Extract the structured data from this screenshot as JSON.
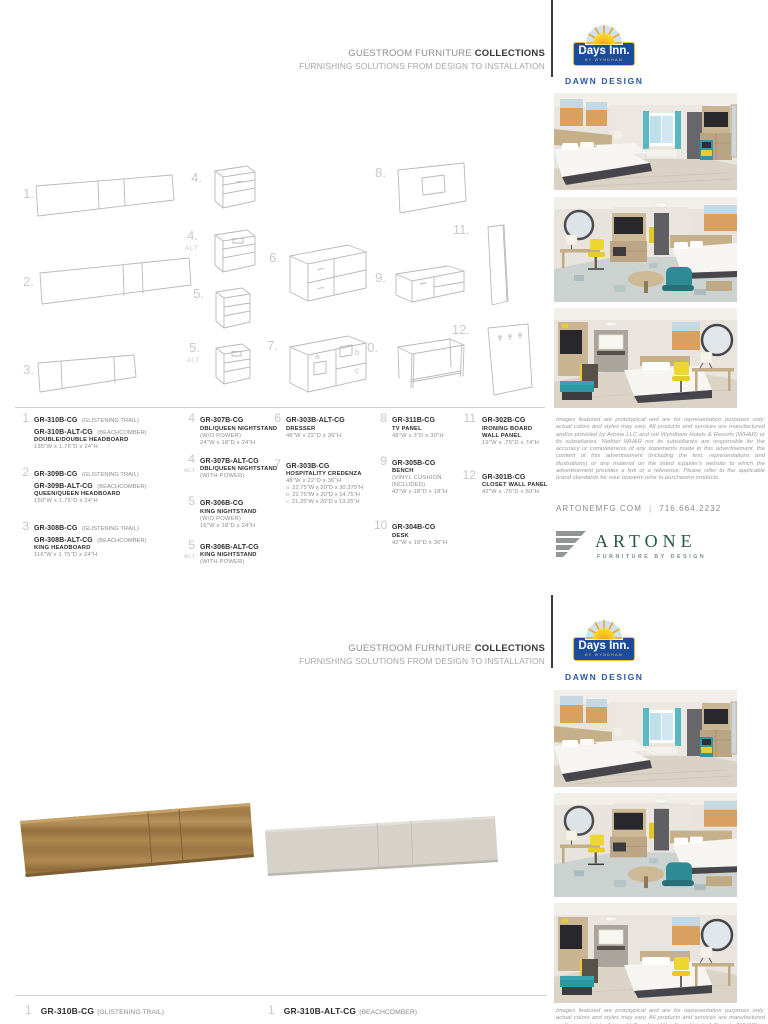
{
  "header": {
    "title_light": "GUESTROOM FURNITURE",
    "title_bold": "COLLECTIONS",
    "subtitle": "FURNISHING SOLUTIONS FROM DESIGN TO INSTALLATION"
  },
  "brand": {
    "logo_text": "Days Inn.",
    "logo_byline": "BY WYNDHAM",
    "collection": "DAWN DESIGN",
    "blue": "#1b4c9c",
    "gold": "#ecbe3a"
  },
  "figure_labels": {
    "f1": "1.",
    "f2": "2.",
    "f3": "3.",
    "f4": "4.",
    "f4alt": "4.",
    "f5": "5.",
    "f5alt": "5.",
    "f6": "6.",
    "f7": "7.",
    "f8": "8.",
    "f9": "9.",
    "f10": "10.",
    "f11": "11.",
    "f12": "12.",
    "alt": "ALT",
    "a": "a",
    "b": "b",
    "c": "c"
  },
  "products": {
    "col1": [
      {
        "num": "1",
        "codes": [
          {
            "code": "GR-310B-CG",
            "finish": "(GLISTENING TRAIL)"
          },
          {
            "code": "GR-310B-ALT-CG",
            "finish": "(BEACHCOMBER)"
          }
        ],
        "name": "DOUBLE/DOUBLE HEADBOARD",
        "dims": "135\"W x 1.75\"D x 24\"H"
      },
      {
        "num": "2",
        "codes": [
          {
            "code": "GR-309B-CG",
            "finish": "(GLISTENING TRAIL)"
          },
          {
            "code": "GR-309B-ALT-CG",
            "finish": "(BEACHCOMBER)"
          }
        ],
        "name": "QUEEN/QUEEN HEADBOARD",
        "dims": "150\"W x 1.75\"D x 24\"H"
      },
      {
        "num": "3",
        "codes": [
          {
            "code": "GR-308B-CG",
            "finish": "(GLISTENING TRAIL)"
          },
          {
            "code": "GR-308B-ALT-CG",
            "finish": "(BEACHCOMBER)"
          }
        ],
        "name": "KING HEADBOARD",
        "dims": "116\"W x 1.75\"D x 24\"H"
      }
    ],
    "col2": [
      {
        "num": "4",
        "code": "GR-307B-CG",
        "name": "DBL/QUEEN NIGHTSTAND",
        "note": "(W/O POWER)",
        "dims": "24\"W x 18\"D x 24\"H"
      },
      {
        "num": "4",
        "code": "GR-307B-ALT-CG",
        "name": "DBL/QUEEN NIGHTSTAND",
        "note": "(WITH POWER)"
      },
      {
        "num": "5",
        "code": "GR-306B-CG",
        "name": "KING NIGHTSTAND",
        "note": "(W/O POWER)",
        "dims": "16\"W x 18\"D x 24\"H"
      },
      {
        "num": "5",
        "code": "GR-306B-ALT-CG",
        "name": "KING NIGHTSTAND",
        "note": "(WITH POWER)"
      }
    ],
    "col3": [
      {
        "num": "6",
        "code": "GR-303B-ALT-CG",
        "name": "DRESSER",
        "dims": "48\"W x 22\"D x 36\"H"
      },
      {
        "num": "7",
        "code": "GR-303B-CG",
        "name": "HOSPITALITY CREDENZA",
        "dims": "48\"W x 22\"D x 36\"H",
        "subs": [
          {
            "key": "a",
            "val": "22.75\"W x 20\"D x 30.375\"H"
          },
          {
            "key": "b",
            "val": "22.75\"W x 20\"D x 14.75\"H"
          },
          {
            "key": "c",
            "val": "21.25\"W x 20\"D x 13.25\"H"
          }
        ]
      }
    ],
    "col4": [
      {
        "num": "8",
        "code": "GR-311B-CG",
        "name": "TV PANEL",
        "dims": "48\"W x 3\"D x 30\"H"
      },
      {
        "num": "9",
        "code": "GR-305B-CG",
        "name": "BENCH",
        "note": "(VINYL CUSHION INCLUDED)",
        "dims": "42\"W x 18\"D x 18\"H"
      },
      {
        "num": "10",
        "code": "GR-304B-CG",
        "name": "DESK",
        "dims": "42\"W x 19\"D x 30\"H"
      }
    ],
    "col5": [
      {
        "num": "11",
        "code": "GR-302B-CG",
        "name": "IRONING BOARD",
        "name2": "WALL PANEL",
        "dims": "19\"W x .75\"D x 74\"H"
      },
      {
        "num": "12",
        "code": "GR-301B-CG",
        "name": "CLOSET WALL PANEL",
        "dims": "42\"W x .75\"D x 60\"H"
      }
    ]
  },
  "disclaimer": "Images featured are prototypical and are for representation purposes only; actual colors and styles may vary. All products and services are manufactured and/or provided by Artone LLC and not Wyndham Hotels & Resorts (WH&R) or its subsidiaries. Neither WH&R nor its subsidiaries are responsible for the accuracy or completeness of any statements made in this advertisement, the content of this advertisement (including the text, representations and illustrations) or any material on the listed supplier's website to which the advertisement provides a link or a reference. Please refer to the applicable brand standards for your property prior to purchasing products.",
  "contact": {
    "website": "ARTONEMFG.COM",
    "separator": "|",
    "phone": "716.664.2232"
  },
  "artone": {
    "name": "ARTONE",
    "tagline": "FURNITURE BY DESIGN"
  },
  "page2_items": [
    {
      "num": "1",
      "code": "GR-310B-CG",
      "finish": "(GLISTENING TRAIL)"
    },
    {
      "num": "1",
      "code": "GR-310B-ALT-CG",
      "finish": "(BEACHCOMBER)"
    }
  ]
}
